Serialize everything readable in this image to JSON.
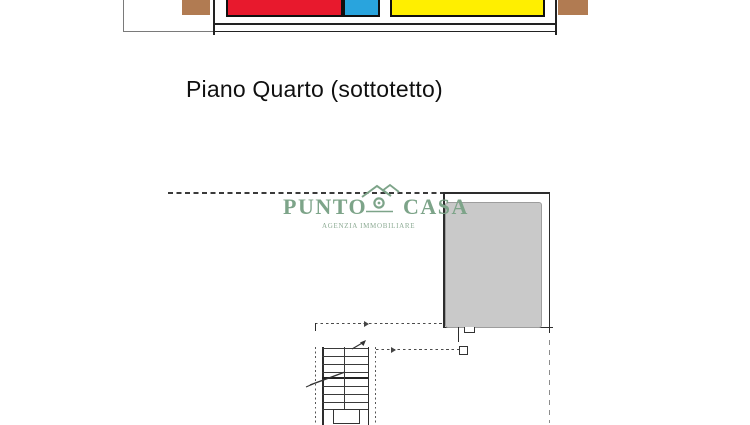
{
  "title": {
    "text": "Piano Quarto (sottotetto)"
  },
  "logo": {
    "word1": "PUNTO",
    "word2": "CASA",
    "subtitle": "AGENZIA IMMOBILIARE",
    "color": "#7da489",
    "subtitle_color": "#8dab94"
  },
  "elevation": {
    "colors": {
      "red": "#e8192d",
      "blue": "#29a4dd",
      "yellow": "#ffef00",
      "brown": "#b17b52"
    }
  },
  "floor_plan": {
    "room_fill": "#c9c9c9"
  }
}
